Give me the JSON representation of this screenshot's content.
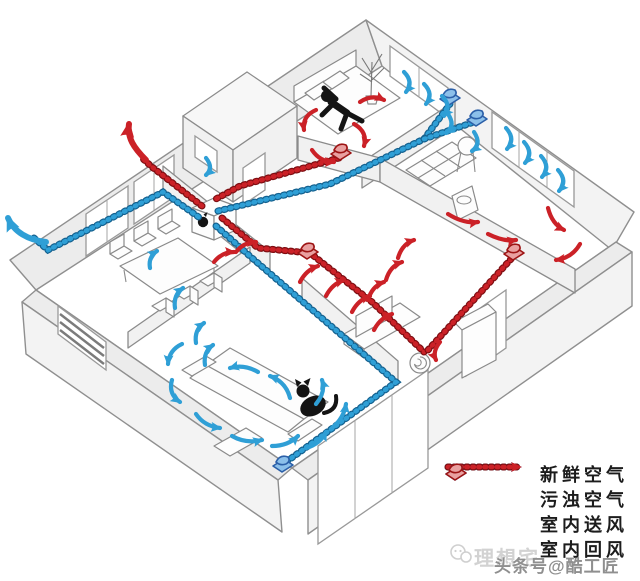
{
  "legend": {
    "items": [
      {
        "label": "新鲜空气",
        "type": "fresh-air-duct"
      },
      {
        "label": "污浊空气",
        "type": "polluted-air-duct"
      },
      {
        "label": "室内送风",
        "type": "indoor-supply-diffuser"
      },
      {
        "label": "室内回风",
        "type": "indoor-return-diffuser"
      }
    ]
  },
  "watermark": {
    "light": "理想宅",
    "dark": "头条号@酷工匠"
  },
  "colors": {
    "fresh": "#2f9fd6",
    "fresh_dark": "#14618f",
    "polluted": "#cb2127",
    "polluted_dark": "#7e0e12",
    "supply_fill": "#8cc0ea",
    "supply_edge": "#2b5fa8",
    "return_fill": "#e9a0a0",
    "return_edge": "#9d1414"
  }
}
